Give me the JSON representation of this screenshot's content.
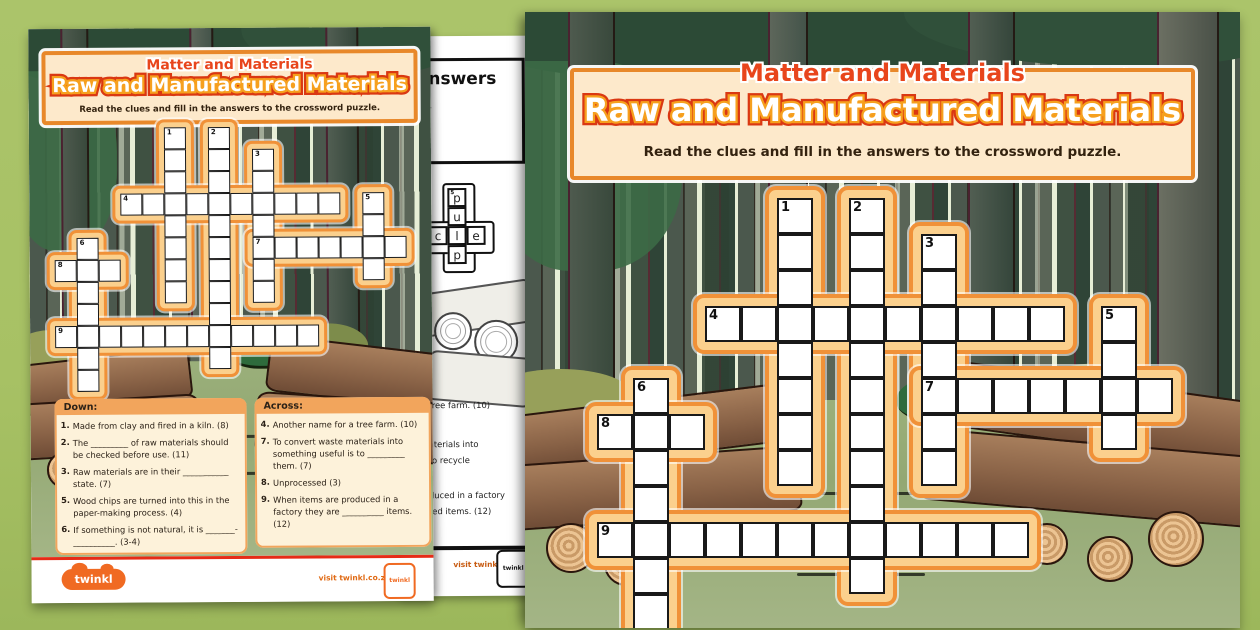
{
  "header": {
    "subject": "Matter and Materials",
    "title": "Raw and Manufactured Materials",
    "instruction": "Read the clues and fill in the answers to the crossword puzzle."
  },
  "clues": {
    "down_title": "Down:",
    "across_title": "Across:",
    "down": [
      {
        "num": "1.",
        "text": "Made from clay and fired in a kiln. (8)"
      },
      {
        "num": "2.",
        "text": "The _________ of raw materials should be checked before use. (11)"
      },
      {
        "num": "3.",
        "text": "Raw materials are in their ___________ state. (7)"
      },
      {
        "num": "5.",
        "text": "Wood chips are turned into this in the paper-making process. (4)"
      },
      {
        "num": "6.",
        "text": "If something is not natural, it is _______-__________. (3-4)"
      }
    ],
    "across": [
      {
        "num": "4.",
        "text": "Another name for a tree farm. (10)"
      },
      {
        "num": "7.",
        "text": "To convert waste materials into something useful is to _________ them. (7)"
      },
      {
        "num": "8.",
        "text": "Unprocessed (3)"
      },
      {
        "num": "9.",
        "text": "When items are produced in a factory they are __________ items. (12)"
      }
    ]
  },
  "crossword": {
    "rows": 12,
    "cols": 16,
    "entries": [
      {
        "num": "1",
        "dir": "down",
        "row": 0,
        "col": 5,
        "len": 8
      },
      {
        "num": "2",
        "dir": "down",
        "row": 0,
        "col": 7,
        "len": 11
      },
      {
        "num": "3",
        "dir": "down",
        "row": 1,
        "col": 9,
        "len": 7
      },
      {
        "num": "4",
        "dir": "across",
        "row": 3,
        "col": 3,
        "len": 10
      },
      {
        "num": "5",
        "dir": "down",
        "row": 3,
        "col": 14,
        "len": 4
      },
      {
        "num": "6",
        "dir": "down",
        "row": 5,
        "col": 1,
        "len": 7
      },
      {
        "num": "7",
        "dir": "across",
        "row": 5,
        "col": 9,
        "len": 7
      },
      {
        "num": "8",
        "dir": "across",
        "row": 6,
        "col": 0,
        "len": 3
      },
      {
        "num": "9",
        "dir": "across",
        "row": 9,
        "col": 0,
        "len": 12
      }
    ]
  },
  "answers_page": {
    "title": "Answers",
    "subtitle_fragment": "cle.",
    "mini_cells": [
      {
        "r": 0,
        "c": 1,
        "letter": "p",
        "num": "5"
      },
      {
        "r": 1,
        "c": 1,
        "letter": "u"
      },
      {
        "r": 2,
        "c": 1,
        "letter": "l"
      },
      {
        "r": 3,
        "c": 1,
        "letter": "p"
      },
      {
        "r": 2,
        "c": 0,
        "letter": "c"
      },
      {
        "r": 2,
        "c": 2,
        "letter": "e"
      }
    ],
    "clue_fragments": [
      "tree farm. (10)",
      "aterials into",
      "to recycle",
      "duced in a factory",
      "red items. (12)"
    ],
    "footer_link": "visit twinkl.co.za"
  },
  "footer": {
    "logo_text": "twinkl",
    "visit_link": "visit twinkl.co.za",
    "badge_text": "twinkl"
  },
  "colors": {
    "background_green": "#a7c164",
    "twinkl_orange": "#f06a22",
    "header_red": "#e0471c",
    "tube_orange": "#f09138",
    "tube_fill": "#fbd08d",
    "header_cream": "#fde9cb",
    "clue_cream": "#fdf2da",
    "clue_band_orange": "#f2a55c",
    "footer_red_line": "#e62b17"
  }
}
